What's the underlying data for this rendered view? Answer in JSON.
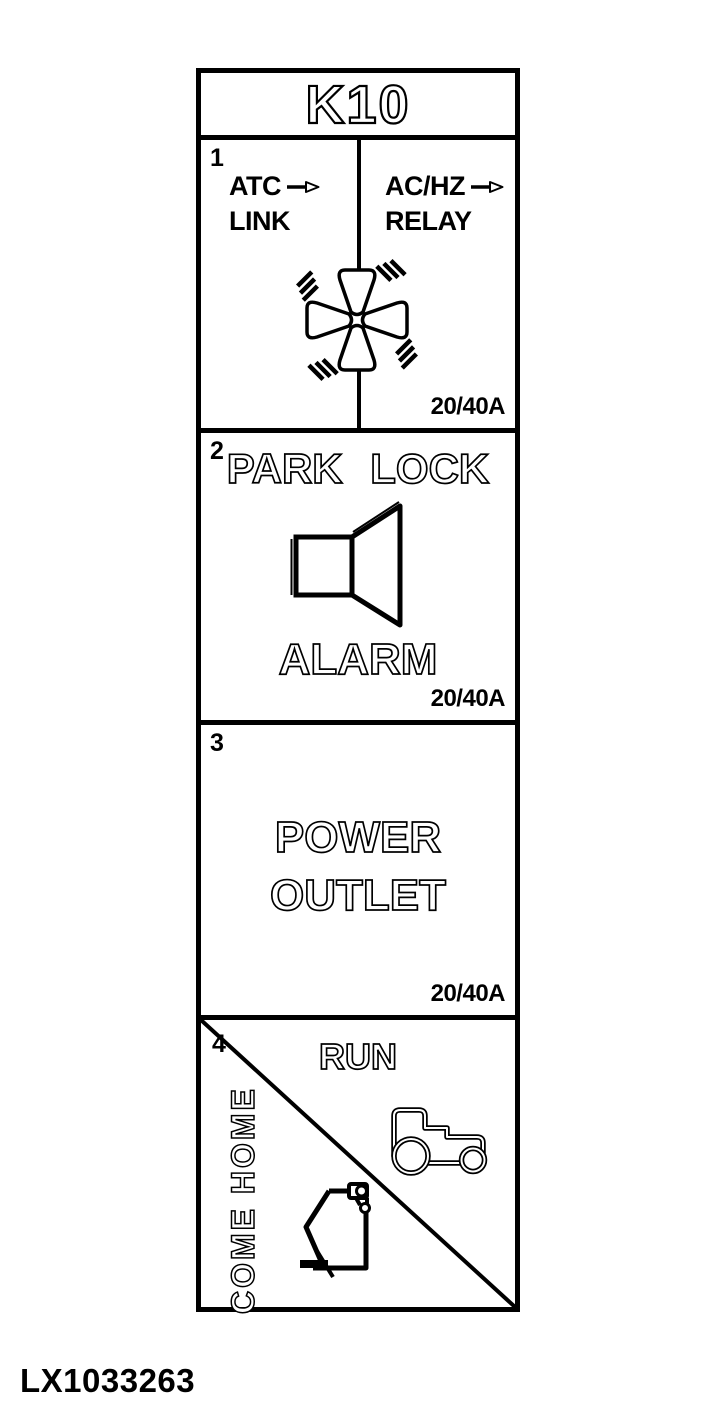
{
  "figure": {
    "code": "LX1033263"
  },
  "icons": {
    "fan": "fan-icon",
    "speaker": "speaker-icon",
    "tractor": "tractor-icon",
    "come_home": "come-home-hitch-icon",
    "arrow": "arrow-right-icon"
  },
  "relay": {
    "title": "K10",
    "sections": [
      {
        "number": "1",
        "left": {
          "line1": "ATC",
          "line2": "LINK"
        },
        "right": {
          "line1": "AC/HZ",
          "line2": "RELAY"
        },
        "icon": "fan-icon",
        "rating": "20/40A"
      },
      {
        "number": "2",
        "title": "PARK LOCK",
        "caption": "ALARM",
        "icon": "speaker-icon",
        "rating": "20/40A"
      },
      {
        "number": "3",
        "title_line1": "POWER",
        "title_line2": "OUTLET",
        "rating": "20/40A"
      },
      {
        "number": "4",
        "top_label": "RUN",
        "side_label": "COME HOME",
        "icons": [
          "tractor-icon",
          "come-home-hitch-icon"
        ]
      }
    ]
  }
}
